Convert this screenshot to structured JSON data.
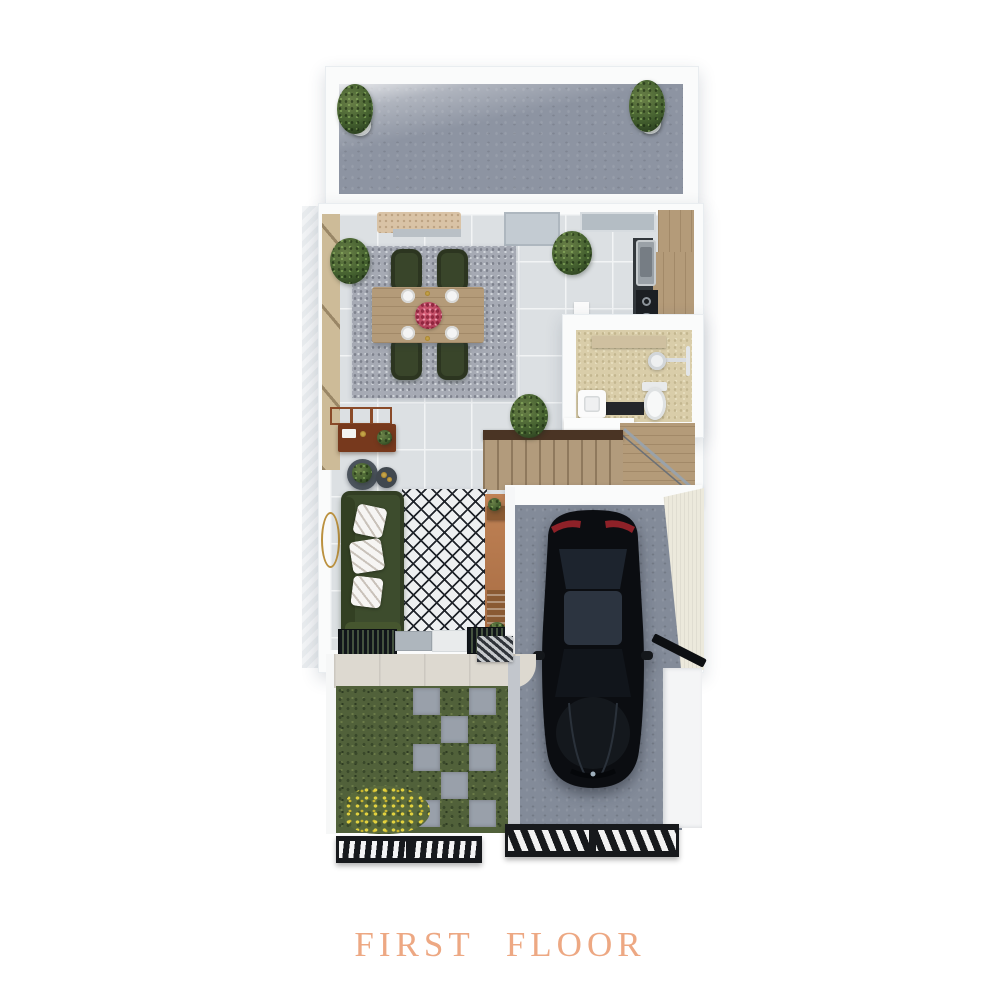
{
  "title": {
    "text": "FIRST FLOOR"
  },
  "palette": {
    "title_text": "#EDA883",
    "wall_white": "#FAFBFB",
    "patio_concrete": "#8D94A2",
    "interior_tile": "#DCE0E3",
    "wood": "#B49B79",
    "bench_sand": "#D9C3A6",
    "chair_green": "#39452A",
    "sofa_green": "#3D4C2D",
    "speckle_rug": "#A6AAB4",
    "diamond_rug_base": "#EEF0F1",
    "diamond_rug_line": "#20242A",
    "console_brown": "#77391D",
    "terracotta": "#BC7E51",
    "bath_floor": "#D9CDA9",
    "stairs_wood": "#B29B7C",
    "stair_rail_brown": "#4A3424",
    "grass_green": "#51613A",
    "flower_yellow": "#D9C838",
    "stepping_stone": "#99A0AA",
    "driveway_concrete": "#838B99",
    "car_black": "#0B0D11",
    "car_taillight_red": "#8E2128",
    "fence_black": "#17191C",
    "mirror_gold": "#BB913F",
    "flower_centerpiece_pink": "#C94F6D"
  }
}
